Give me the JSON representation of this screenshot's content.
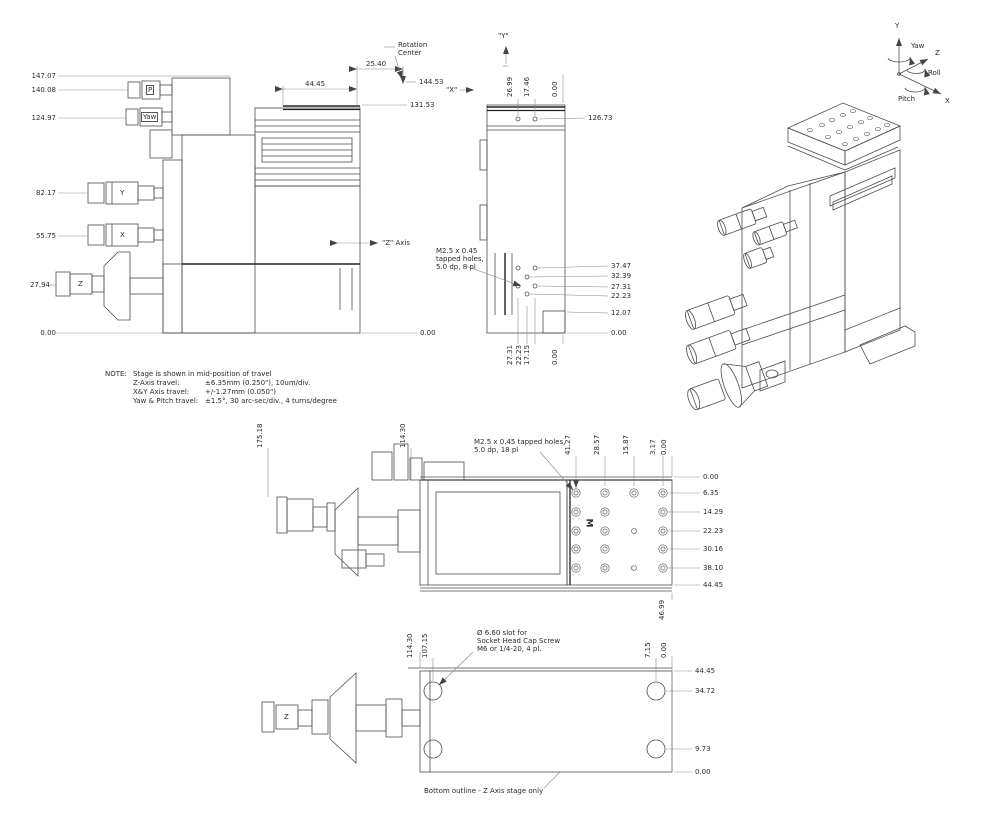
{
  "title": "Multi-axis stage engineering drawing",
  "colors": {
    "background": "#ffffff",
    "body_lines": "#4d4d4d",
    "dim_lines": "#8a8a8a",
    "text": "#2b2b2b"
  },
  "drawing": {
    "front_view": {
      "left_dims": [
        "147.07",
        "140.08",
        "124.97",
        "82.17",
        "55.75",
        "27.94",
        "0.00"
      ],
      "knobs": {
        "p": "P",
        "yaw": "Yaw",
        "y": "Y",
        "x": "X",
        "z": "Z"
      },
      "top": {
        "width": "44.45",
        "offset": "25.40"
      },
      "rotation_center": [
        "Rotation",
        "Center"
      ],
      "right_dims": {
        "height_144": "144.53",
        "height_131": "131.53",
        "base": "0.00"
      },
      "axis_labels": {
        "x": "\"X\"",
        "z": "\"Z\" Axis"
      }
    },
    "side_view": {
      "y_label": "\"Y\"",
      "top_dims": [
        "26.99",
        "17.46",
        "0.00"
      ],
      "hole_height_dim": "126.73",
      "tapped_note": [
        "M2.5 x 0.45",
        "tapped holes,",
        "5.0 dp, 8 pl"
      ],
      "right_dims": [
        "37.47",
        "32.39",
        "27.31",
        "22.23",
        "12.07",
        "0.00"
      ],
      "bottom_dims": [
        "27.31",
        "22.23",
        "17.15",
        "0.00"
      ]
    },
    "axis_indicator": {
      "y": "Y",
      "yaw": "Yaw",
      "z": "Z",
      "roll": "Roll",
      "pitch": "Pitch",
      "x": "X"
    },
    "note": {
      "title": "NOTE:",
      "lines": [
        {
          "a": "Stage is shown in mid-position of travel",
          "b": ""
        },
        {
          "a": "Z-Axis travel:",
          "b": "±6.35mm (0.250\"), 10um/div."
        },
        {
          "a": "X&Y Axis travel:",
          "b": "+/-1.27mm  (0.050\")"
        },
        {
          "a": "Yaw & Pitch travel:",
          "b": "±1.5°, 30 arc-sec/div., 4 turns/degree"
        }
      ]
    },
    "top_view": {
      "left_dims": [
        "175.18",
        "114.30"
      ],
      "tapped_note": [
        "M2.5 x 0.45 tapped holes,",
        "5.0 dp, 18 pl"
      ],
      "top_dims": [
        "41.27",
        "28.57",
        "15.87",
        "3.17",
        "0.00"
      ],
      "right_dims": [
        "0.00",
        "6.35",
        "14.29",
        "22.23",
        "30.16",
        "38.10",
        "44.45"
      ],
      "depth_dim": "46.99",
      "m_mark": "M"
    },
    "bottom_view": {
      "left_dims": [
        "114.30",
        "107.15"
      ],
      "top_dims": [
        "7.15",
        "0.00"
      ],
      "right_dims": [
        "44.45",
        "34.72",
        "9.73",
        "0.00"
      ],
      "slot_note": [
        "Ø 6.60 slot for",
        "Socket Head Cap Screw",
        "M6 or 1/4-20, 4 pl."
      ],
      "z_label": "Z",
      "caption": "Bottom outline - Z Axis stage only"
    }
  }
}
